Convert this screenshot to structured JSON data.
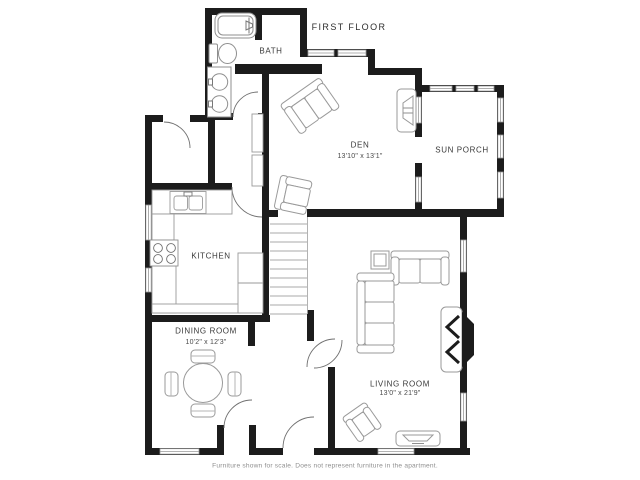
{
  "title": "FIRST FLOOR",
  "footer_note": "Furniture shown for scale. Does not represent furniture in the apartment.",
  "colors": {
    "background": "#ffffff",
    "wall": "#1c1c1c",
    "furniture_line": "#9a9a9a",
    "door_arc_line": "#6f6f6f",
    "label_text": "#3a3a3a",
    "footer_text": "#8f8f8f"
  },
  "rooms": [
    {
      "id": "bath",
      "name": "BATH",
      "dimensions": ""
    },
    {
      "id": "den",
      "name": "DEN",
      "dimensions": "13'10\" x 13'1\""
    },
    {
      "id": "sun_porch",
      "name": "SUN PORCH",
      "dimensions": ""
    },
    {
      "id": "kitchen",
      "name": "KITCHEN",
      "dimensions": ""
    },
    {
      "id": "dining_room",
      "name": "DINING ROOM",
      "dimensions": "10'2\" x 12'3\""
    },
    {
      "id": "living_room",
      "name": "LIVING ROOM",
      "dimensions": "13'0\" x 21'9\""
    }
  ],
  "fixtures": [
    "bathtub-icon",
    "toilet-icon",
    "vanity-double-sink-icon",
    "kitchen-sink-icon",
    "stove-icon",
    "refrigerator-icon",
    "pantry-shelves-icon",
    "staircase-icon",
    "dining-table-icon",
    "loveseat-icon",
    "armchair-icon",
    "sectional-sofa-icon",
    "end-table-icon",
    "tv-icon",
    "media-console-icon",
    "fireplace-icon",
    "door-swing-icon",
    "window-icon"
  ]
}
